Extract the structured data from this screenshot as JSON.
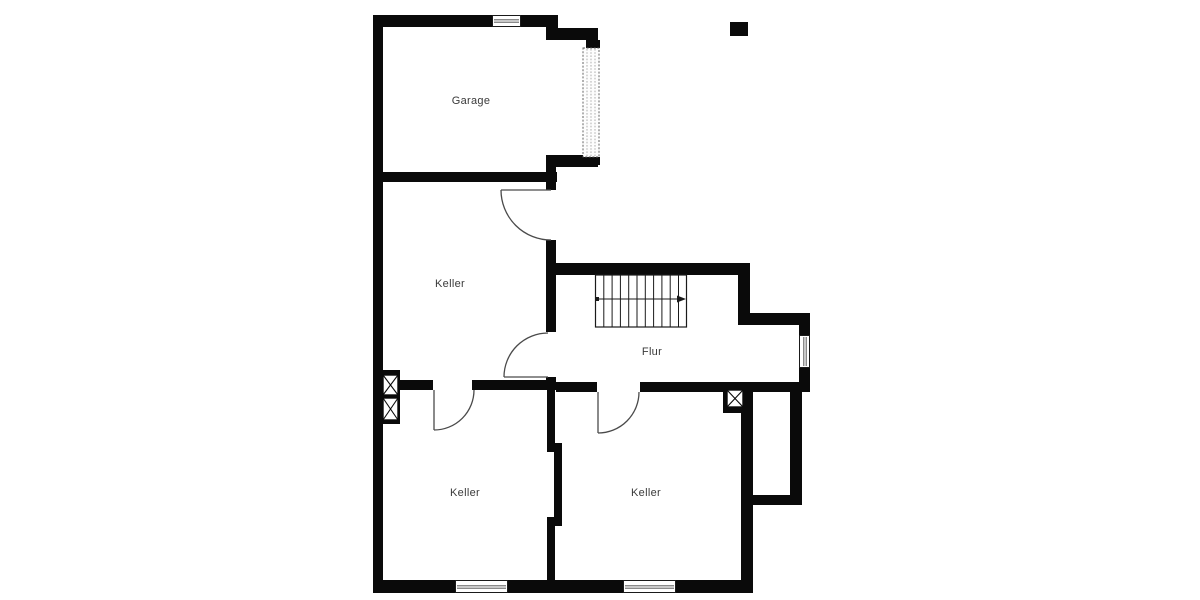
{
  "canvas": {
    "width_px": 1200,
    "height_px": 600,
    "background": "#ffffff"
  },
  "colors": {
    "wall": "#0a0a0a",
    "door_line": "#4a4a4a",
    "window_glass": "#c8c8c8",
    "label_text": "#3a3a3a"
  },
  "rooms": [
    {
      "id": "garage",
      "label": "Garage"
    },
    {
      "id": "keller-middle",
      "label": "Keller"
    },
    {
      "id": "flur",
      "label": "Flur"
    },
    {
      "id": "keller-bottom-left",
      "label": "Keller"
    },
    {
      "id": "keller-bottom-right",
      "label": "Keller"
    }
  ],
  "symbols": {
    "stairs": {
      "treads": 11,
      "walk_line_arrow_direction": "right",
      "location": "flur"
    },
    "garage_door": {
      "location": "garage-right-wall",
      "style": "dotted-sectional"
    },
    "doors": [
      {
        "id": "door-exterior-keller-middle",
        "location": "keller-middle-right-wall"
      },
      {
        "id": "door-flur-to-keller-middle",
        "location": "keller-middle-right-wall-lower"
      },
      {
        "id": "door-keller-bottom-left",
        "location": "keller-bottom-left-top-wall"
      },
      {
        "id": "door-keller-bottom-right",
        "location": "keller-bottom-right-top-wall"
      }
    ],
    "windows": [
      {
        "id": "window-garage-top",
        "orientation": "horizontal"
      },
      {
        "id": "window-flur-right",
        "orientation": "vertical"
      },
      {
        "id": "window-keller-bottom-left",
        "orientation": "horizontal"
      },
      {
        "id": "window-keller-bottom-right",
        "orientation": "horizontal"
      }
    ],
    "shafts": [
      {
        "id": "shaft-left-upper",
        "glyph": "crossed-box"
      },
      {
        "id": "shaft-left-lower",
        "glyph": "crossed-box"
      },
      {
        "id": "shaft-flur-right",
        "glyph": "crossed-box"
      }
    ],
    "marker": {
      "id": "solid-square-marker",
      "shape": "filled-rectangle"
    }
  }
}
